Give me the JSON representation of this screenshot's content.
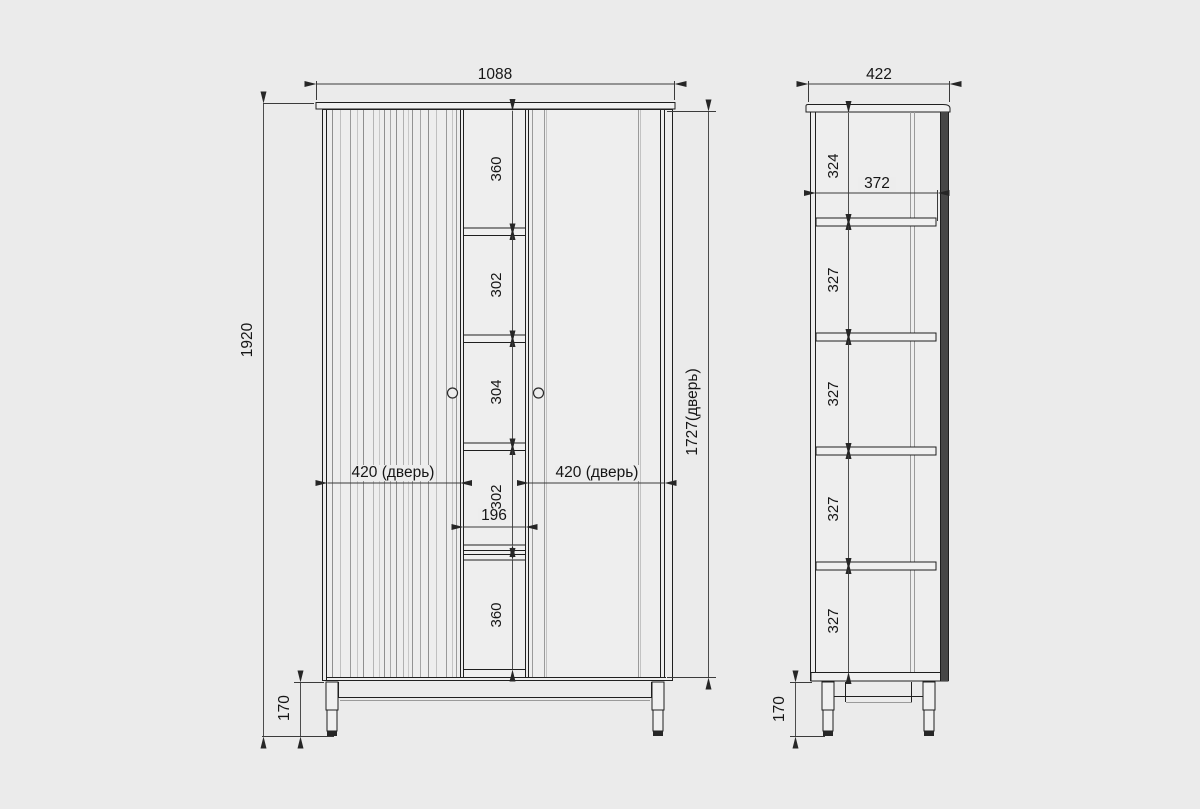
{
  "drawing_type": "furniture dimensional drawing (wardrobe, front and side views)",
  "front_view": {
    "width": "1088",
    "height": "1920",
    "door_height": "1727(дверь)",
    "door_left": "420 (дверь)",
    "door_right": "420 (дверь)",
    "opening_width": "196",
    "legs": "170",
    "sections": [
      "360",
      "302",
      "304",
      "302",
      "360"
    ]
  },
  "side_view": {
    "depth": "422",
    "inner_depth": "372",
    "section_top": "324",
    "sections": [
      "327",
      "327",
      "327",
      "327"
    ],
    "legs": "170"
  },
  "colors": {
    "background": "#ebebeb",
    "outline": "#1f1f1f",
    "detail_gray": "#9a9a9a",
    "dark_fill": "#262626"
  }
}
